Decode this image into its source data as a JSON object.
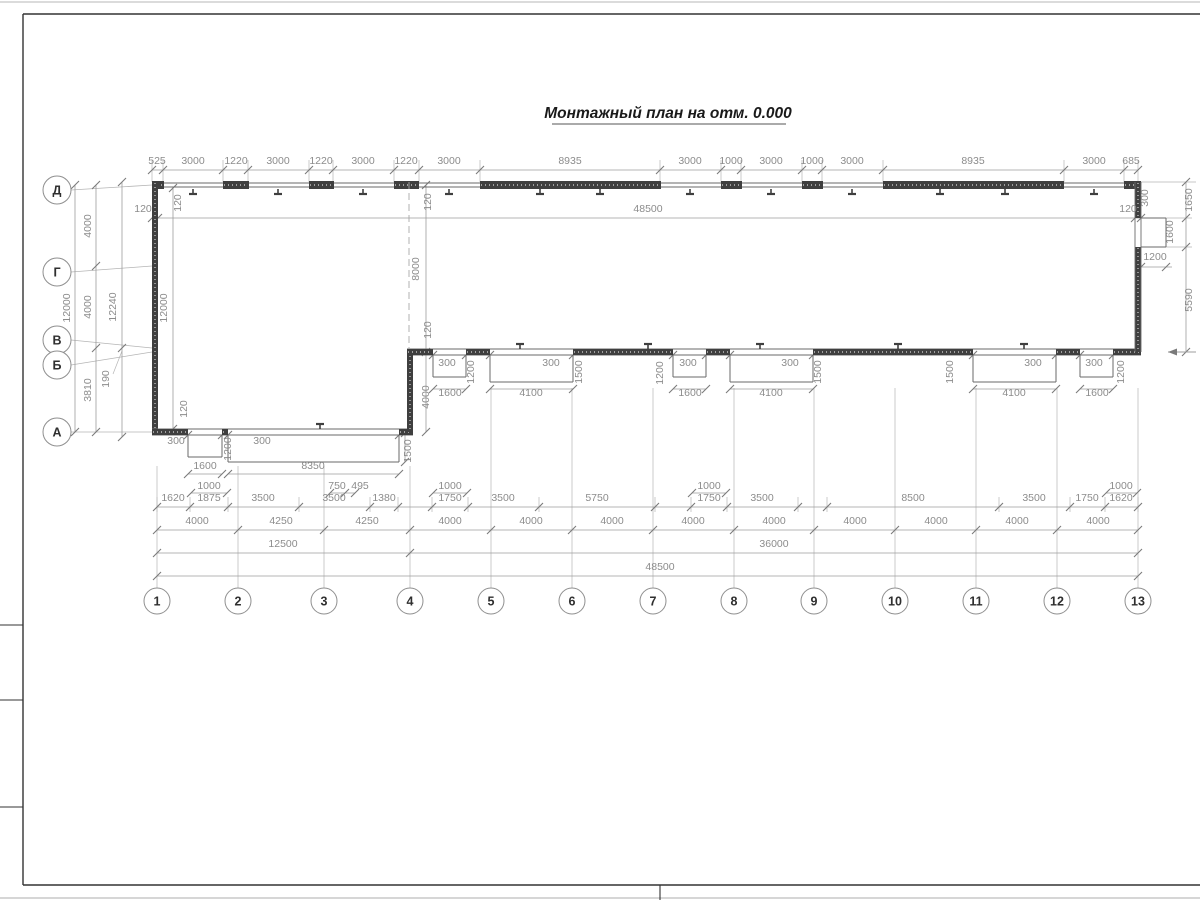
{
  "title": {
    "text": "Монтажный план на отм. 0.000"
  },
  "colors": {
    "wall": "#3f3f3f",
    "thin_wall": "#6a6a6a",
    "dim_line": "#9c9c9c",
    "ext_line": "#b5b5b5",
    "tick": "#7a7a7a",
    "dim_text": "#8c8c8c",
    "axis_text": "#2f2f2f",
    "bubble_stroke": "#8f8f8f",
    "frame": "#333333",
    "title_text": "#1a1a1a"
  },
  "axes": {
    "columns": [
      {
        "label": "1",
        "x": 157
      },
      {
        "label": "2",
        "x": 238
      },
      {
        "label": "3",
        "x": 324
      },
      {
        "label": "4",
        "x": 410
      },
      {
        "label": "5",
        "x": 491
      },
      {
        "label": "6",
        "x": 572
      },
      {
        "label": "7",
        "x": 653
      },
      {
        "label": "8",
        "x": 734
      },
      {
        "label": "9",
        "x": 814
      },
      {
        "label": "10",
        "x": 895
      },
      {
        "label": "11",
        "x": 976
      },
      {
        "label": "12",
        "x": 1057
      },
      {
        "label": "13",
        "x": 1138
      }
    ],
    "rows": [
      {
        "label": "Д",
        "bubble_y": 190,
        "axis_y": 185
      },
      {
        "label": "Г",
        "bubble_y": 272,
        "axis_y": 266
      },
      {
        "label": "В",
        "bubble_y": 340,
        "axis_y": 348
      },
      {
        "label": "Б",
        "bubble_y": 365,
        "axis_y": 352
      },
      {
        "label": "А",
        "bubble_y": 432,
        "axis_y": 432
      }
    ]
  },
  "dim_labels": [
    [
      "525",
      157,
      164,
      0
    ],
    [
      "3000",
      193,
      164,
      0
    ],
    [
      "1220",
      236,
      164,
      0
    ],
    [
      "3000",
      278,
      164,
      0
    ],
    [
      "1220",
      321,
      164,
      0
    ],
    [
      "3000",
      363,
      164,
      0
    ],
    [
      "1220",
      406,
      164,
      0
    ],
    [
      "3000",
      449,
      164,
      0
    ],
    [
      "8935",
      570,
      164,
      0
    ],
    [
      "3000",
      690,
      164,
      0
    ],
    [
      "1000",
      731,
      164,
      0
    ],
    [
      "3000",
      771,
      164,
      0
    ],
    [
      "1000",
      812,
      164,
      0
    ],
    [
      "3000",
      852,
      164,
      0
    ],
    [
      "8935",
      973,
      164,
      0
    ],
    [
      "3000",
      1094,
      164,
      0
    ],
    [
      "685",
      1131,
      164,
      0
    ],
    [
      "120",
      143,
      212,
      0
    ],
    [
      "48500",
      648,
      212,
      0
    ],
    [
      "120",
      1128,
      212,
      0
    ],
    [
      "12000",
      70,
      308,
      1
    ],
    [
      "4000",
      91,
      226,
      1
    ],
    [
      "4000",
      91,
      307,
      1
    ],
    [
      "3810",
      91,
      390,
      1
    ],
    [
      "12240",
      116,
      307,
      1
    ],
    [
      "190",
      109,
      379,
      1
    ],
    [
      "12000",
      167,
      308,
      1
    ],
    [
      "120",
      181,
      203,
      1
    ],
    [
      "120",
      187,
      409,
      1
    ],
    [
      "120",
      431,
      202,
      1
    ],
    [
      "8000",
      419,
      269,
      1
    ],
    [
      "120",
      431,
      330,
      1
    ],
    [
      "300",
      1148,
      198,
      1
    ],
    [
      "1650",
      1192,
      200,
      1
    ],
    [
      "1600",
      1173,
      232,
      1
    ],
    [
      "1200",
      1155,
      260,
      0
    ],
    [
      "5590",
      1192,
      300,
      1
    ],
    [
      "300",
      447,
      366,
      0
    ],
    [
      "1200",
      474,
      372,
      1
    ],
    [
      "1600",
      450,
      396,
      0
    ],
    [
      "300",
      551,
      366,
      0
    ],
    [
      "1500",
      582,
      372,
      1
    ],
    [
      "4100",
      531,
      396,
      0
    ],
    [
      "300",
      688,
      366,
      0
    ],
    [
      "1200",
      663,
      373,
      1
    ],
    [
      "1600",
      690,
      396,
      0
    ],
    [
      "300",
      790,
      366,
      0
    ],
    [
      "1500",
      821,
      372,
      1
    ],
    [
      "4100",
      771,
      396,
      0
    ],
    [
      "300",
      1033,
      366,
      0
    ],
    [
      "1500",
      953,
      372,
      1
    ],
    [
      "4100",
      1014,
      396,
      0
    ],
    [
      "300",
      1094,
      366,
      0
    ],
    [
      "1200",
      1124,
      372,
      1
    ],
    [
      "1600",
      1097,
      396,
      0
    ],
    [
      "300",
      176,
      444,
      0
    ],
    [
      "1200",
      231,
      449,
      1
    ],
    [
      "300",
      262,
      444,
      0
    ],
    [
      "1600",
      205,
      469,
      0
    ],
    [
      "8350",
      313,
      469,
      0
    ],
    [
      "1500",
      411,
      451,
      1
    ],
    [
      "4000",
      429,
      397,
      1
    ],
    [
      "1000",
      209,
      489,
      0
    ],
    [
      "750",
      337,
      489,
      0
    ],
    [
      "495",
      360,
      489,
      0
    ],
    [
      "1000",
      450,
      489,
      0
    ],
    [
      "1000",
      709,
      489,
      0
    ],
    [
      "1000",
      1121,
      489,
      0
    ],
    [
      "1620",
      173,
      501,
      0
    ],
    [
      "1875",
      209,
      501,
      0
    ],
    [
      "3500",
      263,
      501,
      0
    ],
    [
      "3500",
      334,
      501,
      0
    ],
    [
      "1380",
      384,
      501,
      0
    ],
    [
      "1750",
      450,
      501,
      0
    ],
    [
      "3500",
      503,
      501,
      0
    ],
    [
      "5750",
      597,
      501,
      0
    ],
    [
      "1750",
      709,
      501,
      0
    ],
    [
      "3500",
      762,
      501,
      0
    ],
    [
      "8500",
      913,
      501,
      0
    ],
    [
      "3500",
      1034,
      501,
      0
    ],
    [
      "1750",
      1087,
      501,
      0
    ],
    [
      "1620",
      1121,
      501,
      0
    ],
    [
      "4000",
      197,
      524,
      0
    ],
    [
      "4250",
      281,
      524,
      0
    ],
    [
      "4250",
      367,
      524,
      0
    ],
    [
      "4000",
      450,
      524,
      0
    ],
    [
      "4000",
      531,
      524,
      0
    ],
    [
      "4000",
      612,
      524,
      0
    ],
    [
      "4000",
      693,
      524,
      0
    ],
    [
      "4000",
      774,
      524,
      0
    ],
    [
      "4000",
      855,
      524,
      0
    ],
    [
      "4000",
      936,
      524,
      0
    ],
    [
      "4000",
      1017,
      524,
      0
    ],
    [
      "4000",
      1098,
      524,
      0
    ],
    [
      "12500",
      283,
      547,
      0
    ],
    [
      "36000",
      774,
      547,
      0
    ],
    [
      "48500",
      660,
      570,
      0
    ]
  ]
}
